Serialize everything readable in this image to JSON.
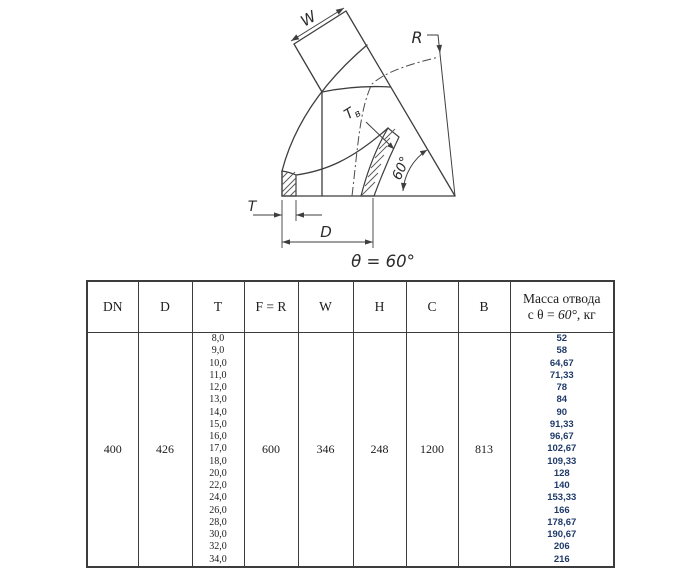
{
  "diagram": {
    "labels": {
      "w": "W",
      "r": "R",
      "t": "T",
      "d": "D",
      "tv_main": "T",
      "tv_sub": "в",
      "angle_arc": "60°",
      "theta_note": "θ = 60°"
    }
  },
  "table": {
    "columns": [
      "DN",
      "D",
      "T",
      "F = R",
      "W",
      "H",
      "C",
      "B"
    ],
    "mass_column": {
      "line1": "Масса отвода",
      "prefix": "с θ = ",
      "angle": "60°",
      "suffix": ", кг"
    },
    "values": {
      "dn": "400",
      "d": "426",
      "f_r": "600",
      "w": "346",
      "h": "248",
      "c": "1200",
      "b": "813"
    },
    "t_values": [
      "8,0",
      "9,0",
      "10,0",
      "11,0",
      "12,0",
      "13,0",
      "14,0",
      "15,0",
      "16,0",
      "17,0",
      "18,0",
      "20,0",
      "22,0",
      "24,0",
      "26,0",
      "28,0",
      "30,0",
      "32,0",
      "34,0"
    ],
    "mass_values": [
      "52",
      "58",
      "64,67",
      "71,33",
      "78",
      "84",
      "90",
      "91,33",
      "96,67",
      "102,67",
      "109,33",
      "128",
      "140",
      "153,33",
      "166",
      "178,67",
      "190,67",
      "206",
      "216"
    ]
  },
  "colors": {
    "line": "#3e3e3e",
    "mass_text": "#1f3a68"
  }
}
